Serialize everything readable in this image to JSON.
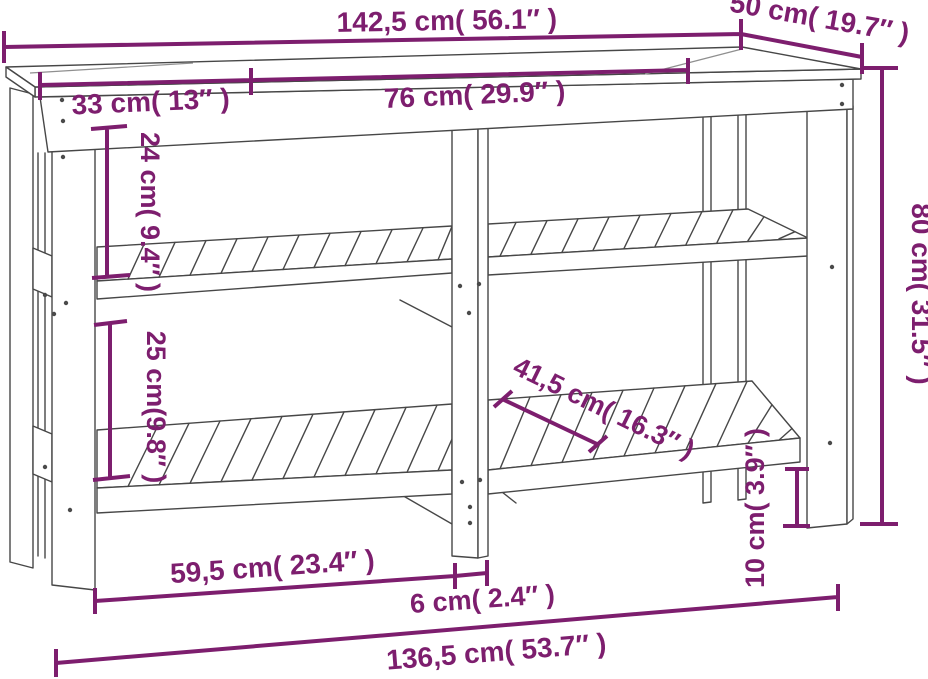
{
  "diagram": {
    "name": "workbench-dimension-diagram",
    "accent_color": "#7d1e6e",
    "outline_color": "#474747",
    "background": "#ffffff",
    "dims": {
      "top_width": {
        "label": "142,5 cm( 56.1″ )",
        "cm": 142.5,
        "in": 56.1
      },
      "top_depth": {
        "label": "50 cm( 19.7″ )",
        "cm": 50,
        "in": 19.7
      },
      "overhang_left": {
        "label": "33 cm( 13″ )",
        "cm": 33,
        "in": 13
      },
      "mid_span": {
        "label": "76 cm( 29.9″ )",
        "cm": 76,
        "in": 29.9
      },
      "top_to_shelf": {
        "label": "24 cm( 9.4″ )",
        "cm": 24,
        "in": 9.4
      },
      "shelf_to_shelf": {
        "label": "25 cm(9.8″ )",
        "cm": 25,
        "in": 9.8
      },
      "shelf_depth": {
        "label": "41,5 cm( 16.3″ )",
        "cm": 41.5,
        "in": 16.3
      },
      "height": {
        "label": "80 cm( 31.5″ )",
        "cm": 80,
        "in": 31.5
      },
      "foot_clearance": {
        "label": "10 cm( 3.9″ )",
        "cm": 10,
        "in": 3.9
      },
      "shelf_span_left": {
        "label": "59,5 cm( 23.4″ )",
        "cm": 59.5,
        "in": 23.4
      },
      "leg_width": {
        "label": "6 cm( 2.4″ )",
        "cm": 6,
        "in": 2.4
      },
      "base_width": {
        "label": "136,5 cm( 53.7″ )",
        "cm": 136.5,
        "in": 53.7
      }
    }
  }
}
